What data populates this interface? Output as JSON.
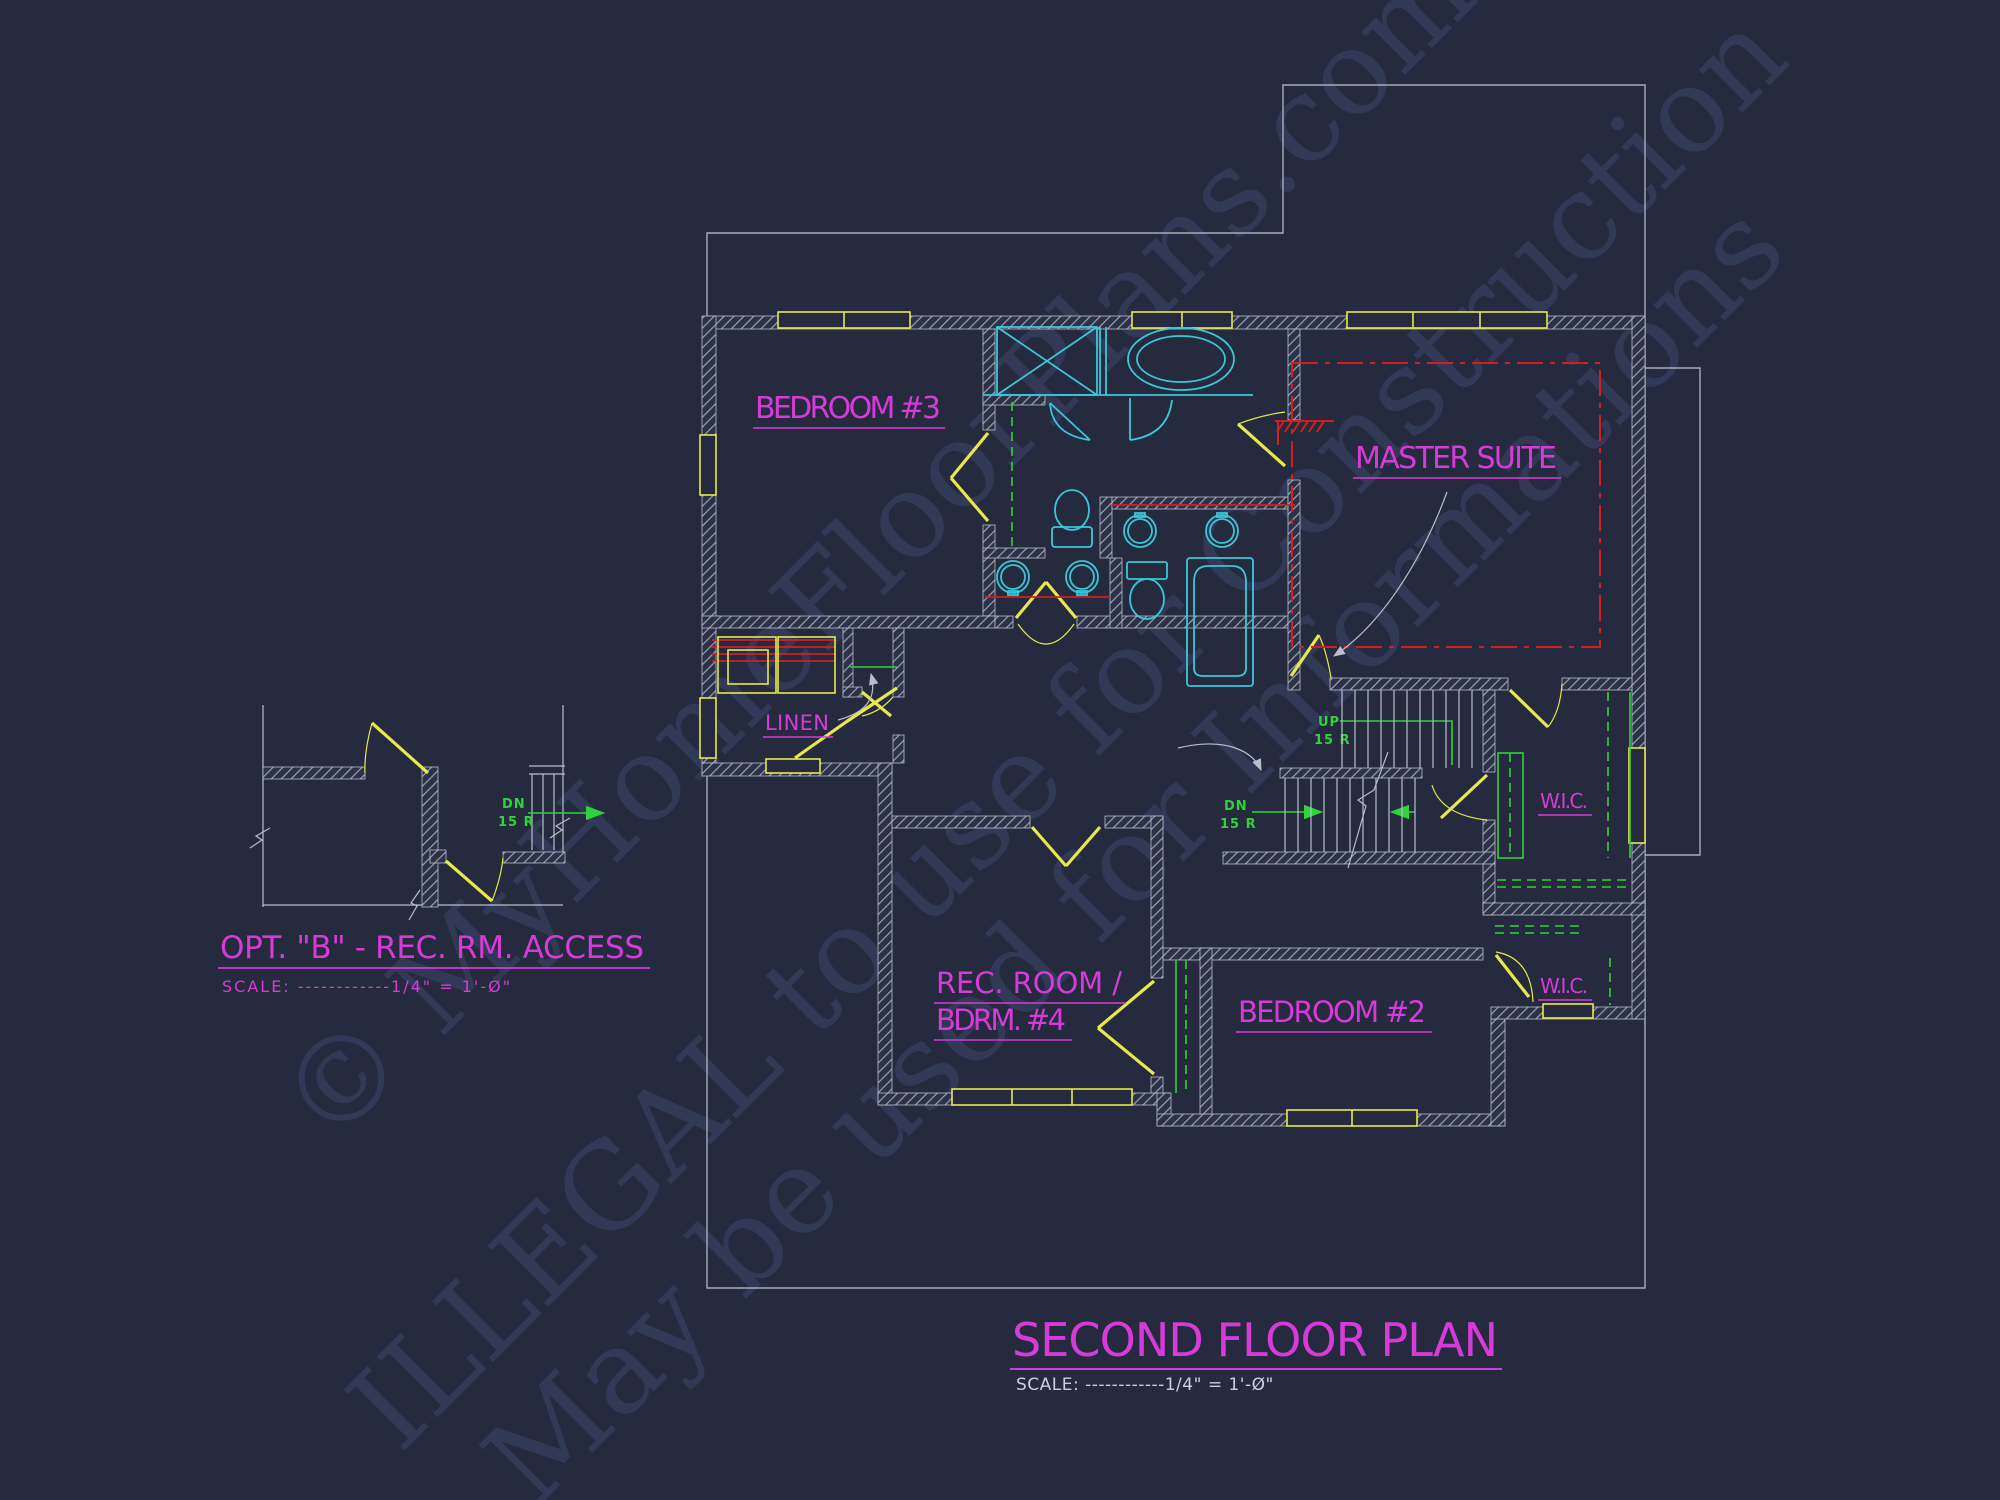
{
  "plan": {
    "labels": {
      "bedroom3": "BEDROOM #3",
      "master_suite": "MASTER SUITE",
      "linen": "LINEN",
      "wic1": "W.I.C.",
      "wic2": "W.I.C.",
      "rec_room_line1": "REC. ROOM /",
      "rec_room_line2": "BDRM. #4",
      "bedroom2": "BEDROOM #2"
    },
    "stairs": {
      "up": "UP",
      "dn": "DN",
      "risers": "15 R"
    },
    "option_b": {
      "dn": "DN",
      "risers": "15 R",
      "title": "OPT. \"B\" - REC. RM. ACCESS",
      "scale": "SCALE: ------------1/4\" = 1'-Ø\""
    },
    "title_block": {
      "title": "SECOND FLOOR PLAN",
      "scale": "SCALE: ------------1/4\" = 1'-Ø\""
    },
    "watermark": {
      "line1": "© MyHomeFloorPlans.com",
      "line2": "ILLEGAL to use for Construction",
      "line3": "May be used for Informations"
    },
    "colors": {
      "background": "#252a3e",
      "wall_gray": "#b9bec9",
      "outline_gray": "#a6acb9",
      "door_window_yellow": "#e8e84d",
      "fixture_cyan": "#38c8da",
      "closet_green": "#2fd33a",
      "counter_red": "#cf2020",
      "label_magenta": "#d63bd9",
      "watermark_navy": "#363d5e"
    }
  }
}
